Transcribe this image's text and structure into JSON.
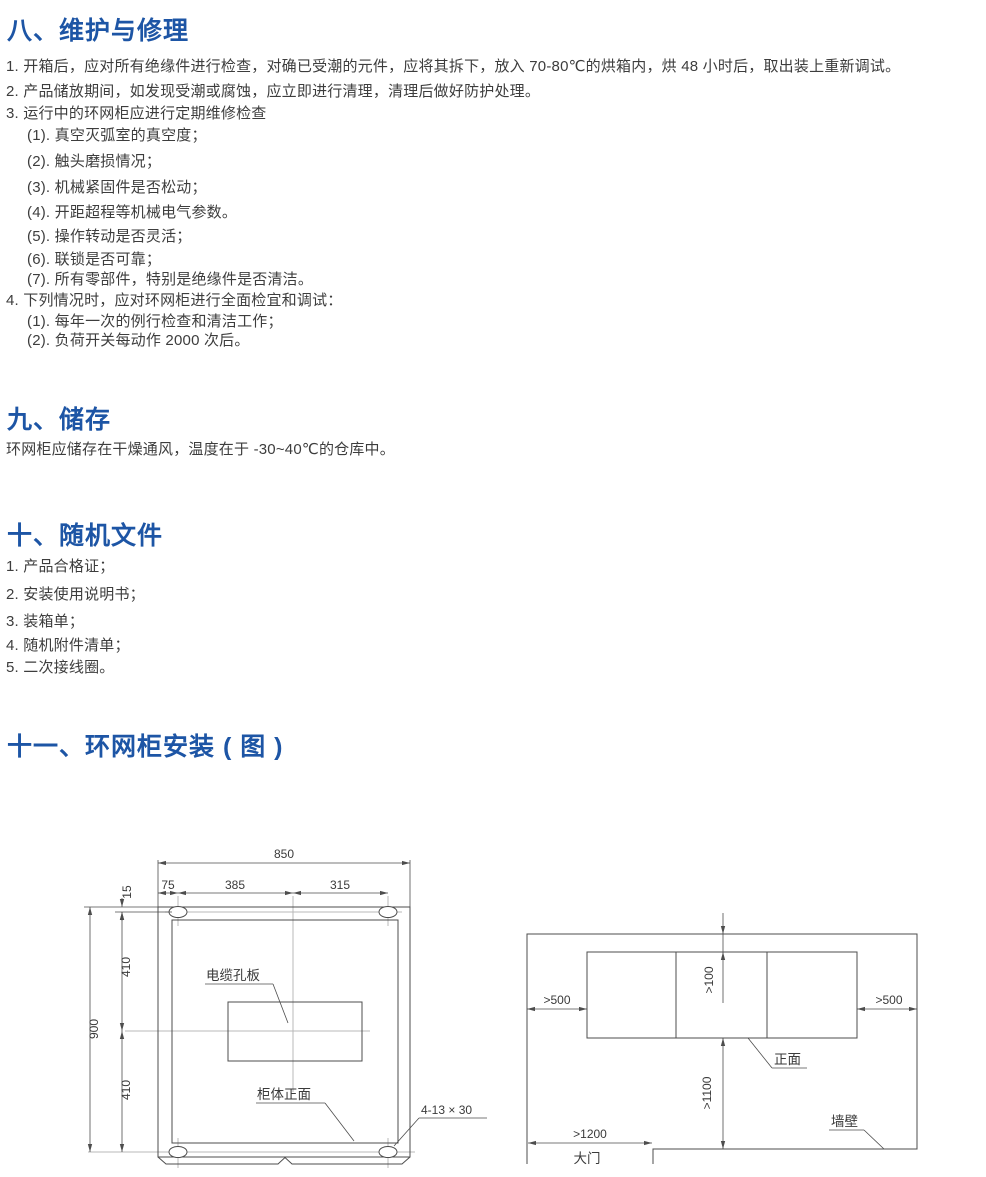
{
  "page": {
    "heading_color": "#1d55a5",
    "body_color": "#3d3d3d",
    "drawing_line_color": "#4d4d4d",
    "centerline_color": "#b9b9b9"
  },
  "sec8": {
    "title": "八、维护与修理",
    "lines": [
      "1. 开箱后，应对所有绝缘件进行检查，对确已受潮的元件，应将其拆下，放入 70-80℃的烘箱内，烘 48 小时后，取出装上重新调试。",
      "2. 产品储放期间，如发现受潮或腐蚀，应立即进行清理，清理后做好防护处理。",
      "3. 运行中的环网柜应进行定期维修检查",
      "(1). 真空灭弧室的真空度；",
      "(2). 触头磨损情况；",
      "(3). 机械紧固件是否松动；",
      "(4). 开距超程等机械电气参数。",
      "(5). 操作转动是否灵活；",
      "(6). 联锁是否可靠；",
      "(7). 所有零部件，特别是绝缘件是否清洁。",
      "4.  下列情况时，应对环网柜进行全面检宜和调试：",
      "(1). 每年一次的例行检查和清洁工作；",
      "(2). 负荷开关每动作 2000 次后。"
    ]
  },
  "sec9": {
    "title": "九、储存",
    "body": "环网柜应储存在干燥通风，温度在于 -30~40℃的仓库中。"
  },
  "sec10": {
    "title": "十、随机文件",
    "lines": [
      "1. 产品合格证；",
      "2. 安装使用说明书；",
      "3. 装箱单；",
      "4. 随机附件清单；",
      "5. 二次接线圈。"
    ]
  },
  "sec11": {
    "title": "十一、环网柜安装 ( 图 )"
  },
  "dwgL": {
    "dim_850": "850",
    "dim_75": "75",
    "dim_385": "385",
    "dim_315": "315",
    "dim_15": "15",
    "dim_410_top": "410",
    "dim_900": "900",
    "dim_410_bottom": "410",
    "label_cable_plate": "电缆孔板",
    "label_cabinet_front": "柜体正面",
    "label_slots": "4-13 × 30"
  },
  "dwgR": {
    "dim_back": ">100",
    "dim_left": ">500",
    "dim_right": ">500",
    "dim_front": ">1100",
    "dim_door": ">1200",
    "label_front": "正面",
    "label_wall": "墙壁",
    "label_door": "大门"
  }
}
